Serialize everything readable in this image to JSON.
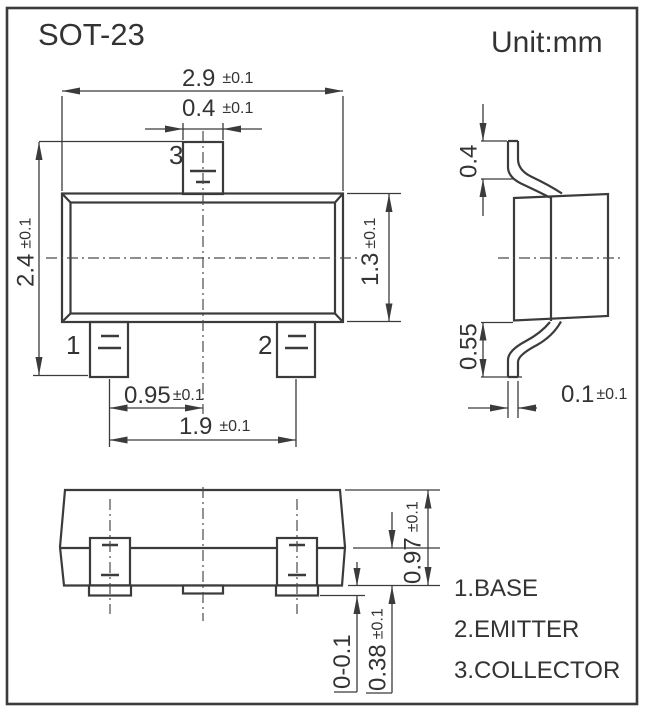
{
  "header": {
    "title": "SOT-23",
    "unit": "Unit:mm"
  },
  "pin_labels": {
    "pin1": "1",
    "pin2": "2",
    "pin3": "3"
  },
  "dims": {
    "body_width": {
      "v": "2.9",
      "tol": "±0.1"
    },
    "pin3_width": {
      "v": "0.4",
      "tol": "±0.1"
    },
    "overall_width": {
      "v": "2.4",
      "tol": "±0.1"
    },
    "body_depth": {
      "v": "1.3",
      "tol": "±0.1"
    },
    "pin_pitch": {
      "v": "0.95",
      "tol": "±0.1"
    },
    "pin_span": {
      "v": "1.9",
      "tol": "±0.1"
    },
    "lead_top": {
      "v": "0.4",
      "tol": ""
    },
    "lead_bottom": {
      "v": "0.55",
      "tol": ""
    },
    "lead_thickness": {
      "v": "0.1",
      "tol": "±0.1"
    },
    "pkg_height": {
      "v": "0.97",
      "tol": "±0.1"
    },
    "lead_height": {
      "v": "0.38",
      "tol": "±0.1"
    },
    "standoff": {
      "v": "0-0.1",
      "tol": ""
    }
  },
  "legend": {
    "items": [
      "1.BASE",
      "2.EMITTER",
      "3.COLLECTOR"
    ]
  },
  "colors": {
    "line": "#3b3b3b",
    "text": "#333333",
    "background": "#ffffff"
  }
}
